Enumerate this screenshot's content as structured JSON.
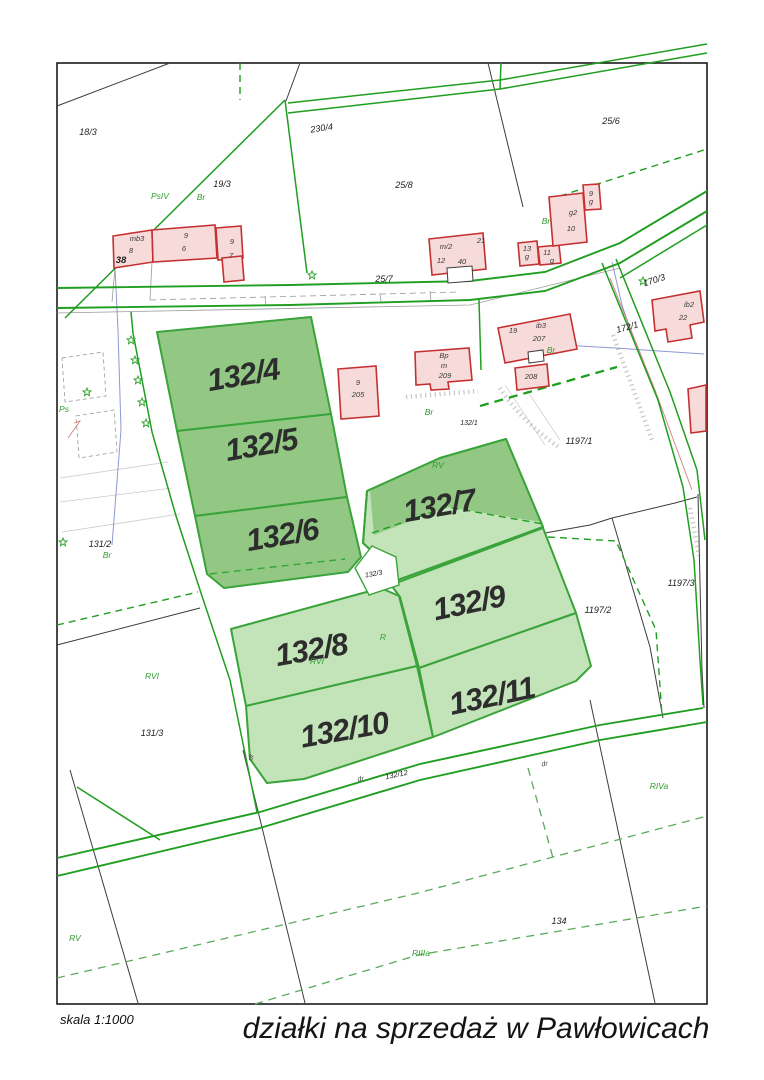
{
  "page": {
    "title": "działki na sprzedaż w Pawłowicach",
    "scale": "skala 1:1000"
  },
  "colors": {
    "parcel_fill_dark": "#92c884",
    "parcel_fill_light": "#c3e3b9",
    "parcel_stroke": "#3aa43a",
    "boundary_green": "#1f9e1f",
    "building_fill": "#f7dada",
    "building_stroke": "#c53030",
    "utility_blue": "#7b86cc",
    "utility_red": "#cc6666",
    "label_dark": "#1c1c1c",
    "landuse_green": "#2f9e2f",
    "sale_label": "#2d2d2d"
  },
  "sale_parcels": [
    {
      "label": "132/4"
    },
    {
      "label": "132/5"
    },
    {
      "label": "132/6"
    },
    {
      "label": "132/7"
    },
    {
      "label": "132/8"
    },
    {
      "label": "132/9"
    },
    {
      "label": "132/10"
    },
    {
      "label": "132/11"
    }
  ],
  "parcel_numbers": [
    "18/3",
    "19/3",
    "230/4",
    "25/8",
    "25/6",
    "25/7",
    "170/3",
    "172/1",
    "1197/1",
    "1197/2",
    "1197/3",
    "132/1",
    "132/3",
    "132/12",
    "131/2",
    "131/3",
    "134"
  ],
  "landuse": [
    "PsIV",
    "Br",
    "Br",
    "Br",
    "Br",
    "Br",
    "RV",
    "RV",
    "RVI",
    "RVI",
    "R",
    "RIVa",
    "RIIIa",
    "Ps"
  ],
  "buildings": [
    "38",
    "mb3",
    "8",
    "9",
    "6",
    "9",
    "7",
    "m/2",
    "12",
    "40",
    "21",
    "13",
    "g",
    "11",
    "g",
    "g2",
    "10",
    "9",
    "g",
    "19",
    "ib3",
    "207",
    "208",
    "9",
    "205",
    "Bp",
    "m",
    "209",
    "ib2",
    "22"
  ],
  "road_labels": [
    "dr",
    "dr",
    "dr"
  ]
}
